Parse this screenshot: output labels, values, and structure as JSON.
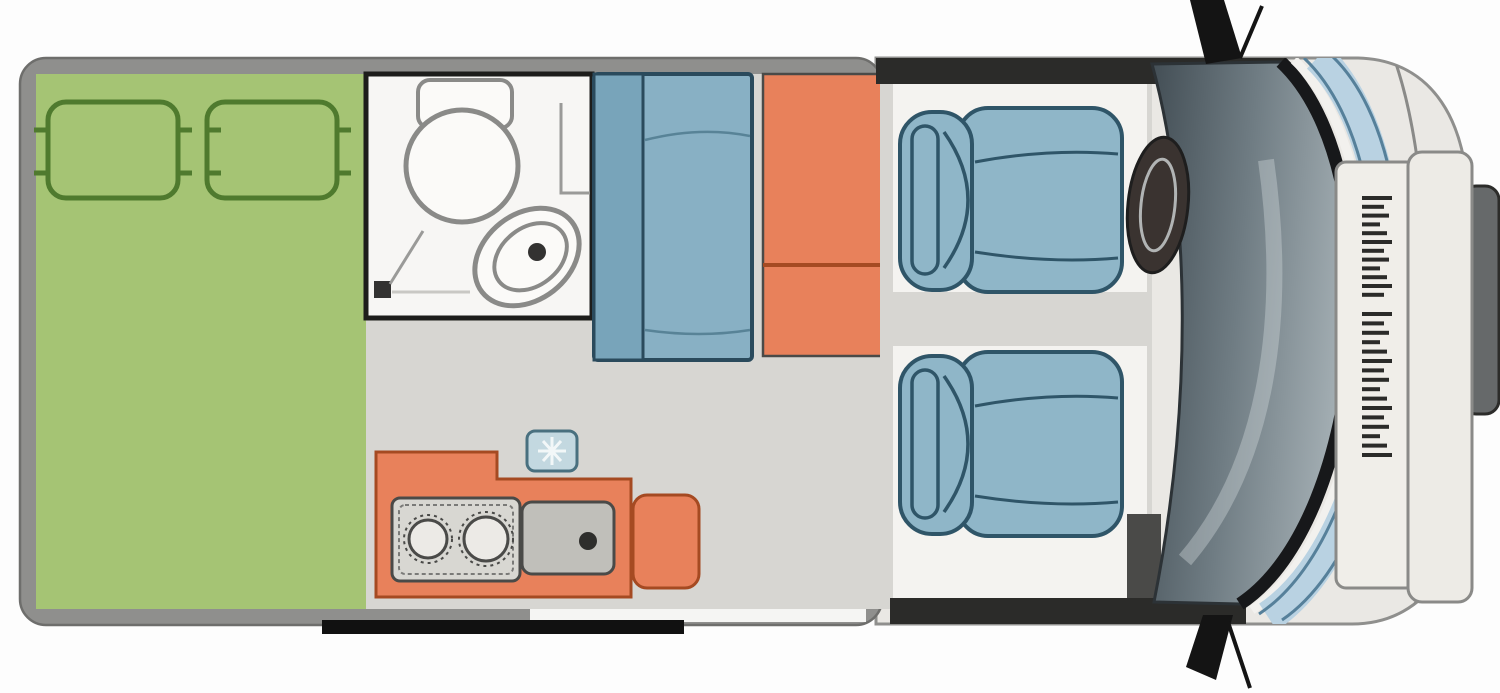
{
  "diagram": {
    "type": "motorhome-floorplan-top-view",
    "vehicle": "campervan",
    "facing": "right",
    "areas": [
      {
        "id": "rear-bedroom",
        "label": "double-bed-area",
        "color_key": "bedroom_green"
      },
      {
        "id": "bathroom",
        "label": "wet-room",
        "color_key": "bathroom_white"
      },
      {
        "id": "living-galley",
        "label": "living-and-galley",
        "color_key": "floor"
      },
      {
        "id": "cab",
        "label": "driver-cab",
        "color_key": "cab_floor"
      }
    ],
    "furniture": [
      "double-bed",
      "pillow-left",
      "pillow-right",
      "toilet",
      "washbasin",
      "shower-screen",
      "sofa-bench",
      "wardrobe",
      "kitchen-counter",
      "stove-two-burner",
      "kitchen-sink",
      "roof-vent-box",
      "driver-seat",
      "passenger-seat",
      "steering-wheel",
      "dashboard",
      "windshield",
      "hood",
      "grille",
      "bumper",
      "tow-step",
      "side-mirror-top",
      "side-mirror-bottom",
      "entry-step",
      "sliding-door"
    ],
    "counts": {
      "pillows": 2,
      "stove_burners": 2,
      "cab_seats": 2
    },
    "colors": {
      "background": "#fdfdfd",
      "wall": "#8f8f8d",
      "wall_edge": "#6e6e6c",
      "wall_dark": "#2b2b29",
      "floor": "#d7d6d2",
      "bedroom_green": "#a5c474",
      "green_outline": "#4f7a2e",
      "bathroom_white": "#f7f6f4",
      "fixture_outline": "#8a8a88",
      "dark_detail": "#333231",
      "sofa_back": "#78a4ba",
      "sofa_seat": "#88b0c4",
      "sofa_outline": "#2a4a5c",
      "orange": "#e8815b",
      "orange_line": "#a54a22",
      "appliance_gray": "#d8d7d2",
      "sink_gray": "#c0bfba",
      "seat_blue": "#8fb6c8",
      "seat_outline": "#2f5568",
      "cab_floor": "#f4f3f0",
      "body_light": "#eae8e4",
      "panel_light": "#f0eee9",
      "panel_mid": "#edebe6",
      "glass_dark_1": "#434e55",
      "glass_dark_2": "#6f7c83",
      "glass_dark_3": "#a2adb2",
      "windshield_blue": "#b9d2e2",
      "windshield_blue_edge": "#56809a",
      "black": "#17181a",
      "nose_dark": "#66696a",
      "step_black": "#111111",
      "small_box_blue": "#c3d8e0",
      "small_box_edge": "#49707f",
      "door_white": "#f5f5f3"
    },
    "front": {
      "grille_hatch": {
        "x": 1362,
        "width": 30,
        "height": 4,
        "groups": [
          {
            "y": 196,
            "count": 12,
            "pitch": 8.8
          },
          {
            "y": 312,
            "count": 16,
            "pitch": 9.4
          }
        ]
      }
    }
  }
}
